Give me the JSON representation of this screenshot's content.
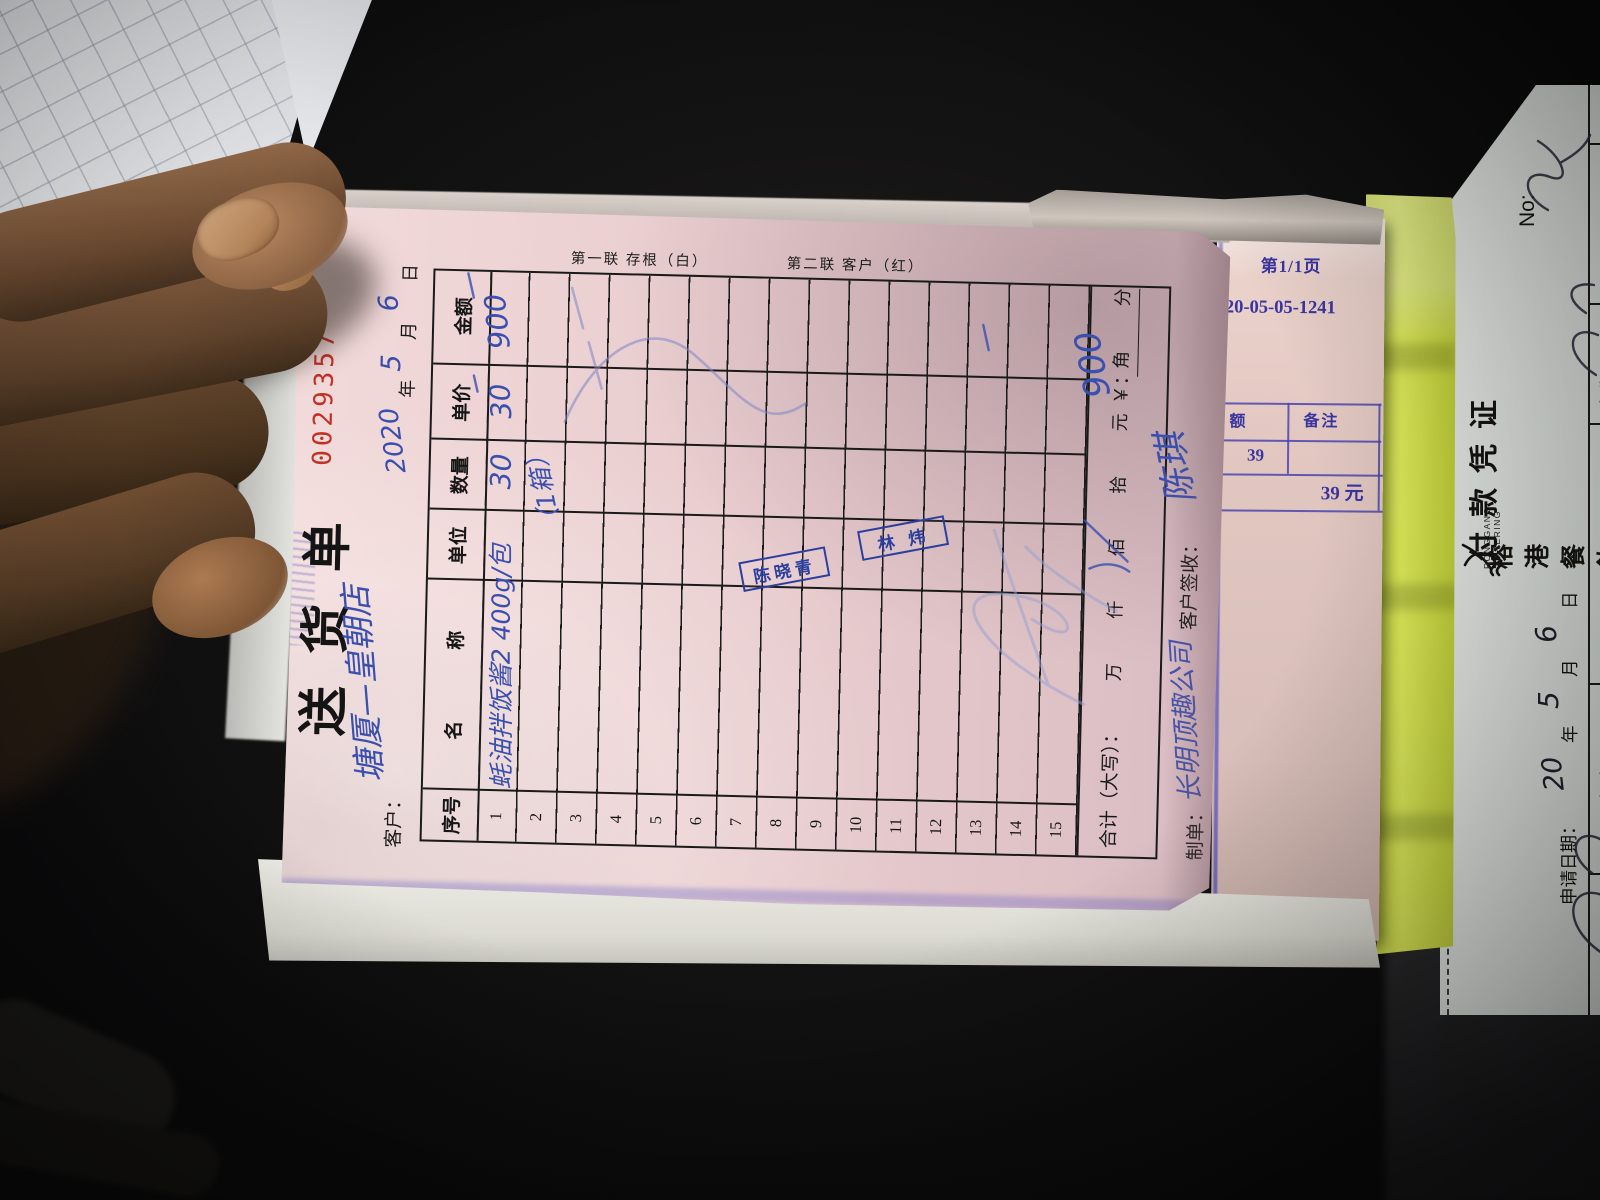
{
  "colors": {
    "pink_paper": "#e9cdcf",
    "serial_red": "#c23126",
    "pen_blue": "#3a4fae",
    "slip_print_blue": "#4a44b0",
    "stamp_blue": "#2c3f9e",
    "yellow_strip": "#dcea52"
  },
  "delivery_note": {
    "serial": "0029357",
    "title": "送货单",
    "copy_labels": [
      "第一联 存根（白）",
      "第二联 客户（红）"
    ],
    "customer_label": "客户：",
    "customer_value": "塘厦—皇朝店",
    "date": {
      "year": "2020",
      "year_unit": "年",
      "month": "5",
      "month_unit": "月",
      "day": "6",
      "day_unit": "日"
    },
    "columns": [
      "序号",
      "名　称",
      "单位",
      "数量",
      "单价",
      "金额"
    ],
    "row_numbers": [
      "1",
      "2",
      "3",
      "4",
      "5",
      "6",
      "7",
      "8",
      "9",
      "10",
      "11",
      "12",
      "13",
      "14",
      "15"
    ],
    "row1": {
      "name": "蚝油拌饭酱2 400g/包",
      "qty": "30",
      "price": "30",
      "amount": "900"
    },
    "row2_note": "（1箱）",
    "total_label": "合计（大写）：",
    "total_units": "万 仟 佰 拾 元 角 分",
    "currency_label": "￥：",
    "total_value": "900",
    "maker_label": "制单：",
    "maker_value": "长明顶趣公司",
    "sign_label": "客户签收：",
    "sign_value": "陈琪",
    "stamps": [
      "陈晓青",
      "林炜"
    ]
  },
  "summary_slip": {
    "page": "第1/1页",
    "ref": "2020-05-05-1241",
    "col_amount": "额",
    "col_note": "备注",
    "amount": "39",
    "total": "39 元"
  },
  "voucher": {
    "brand": "榕港餐飲",
    "brand_en": "RONGGANG CATERING",
    "title": "付款凭证",
    "no_label": "No:",
    "apply_date_label": "申请日期：",
    "date": {
      "d1": "20",
      "u1": "年",
      "d2": "5",
      "u2": "月",
      "d3": "6",
      "u3": "日"
    },
    "col_store": "门店",
    "col_name": "名称"
  }
}
